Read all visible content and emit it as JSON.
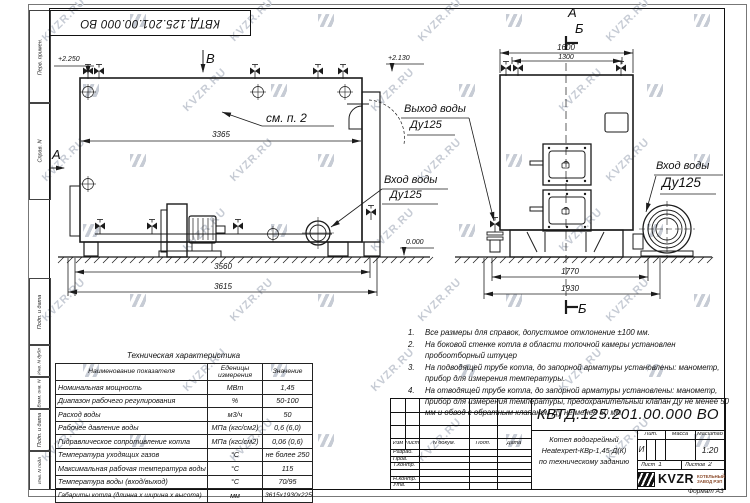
{
  "watermark": {
    "text": "KVZR.RU"
  },
  "sheet": {
    "flipped_doc_number": "КВТД.125.201.00.000 ВО",
    "format_note": "Формат А3"
  },
  "side_columns": {
    "items": [
      "Перв. примен.",
      "Справ. N",
      "Подп. и дата",
      "Инв. N дубл",
      "Взам. инв. N",
      "Подп. и дата",
      "Инв. N подл"
    ]
  },
  "views": {
    "side_view": {
      "view_label": "В",
      "section_label": "А",
      "callout": "см. п. 2",
      "elevation_top": "+2.250",
      "elevation_stack": "+2.130",
      "elevation_ground": "0.000",
      "dim_body": "3365",
      "dim_base": "3560",
      "dim_overall": "3615",
      "inlet_line1": "Вход воды",
      "inlet_line2": "Ду125"
    },
    "front_view": {
      "label_a": "А",
      "label_b": "Б",
      "label_b_bottom": "Б",
      "dim_top_outer": "1600",
      "dim_top_inner": "1300",
      "dim_base_inner": "1770",
      "dim_base_outer": "1930",
      "outlet_line1": "Выход воды",
      "outlet_line2": "Ду125",
      "inlet_line1": "Вход воды",
      "inlet_line2": "Ду125"
    }
  },
  "notes": {
    "items": [
      {
        "num": "1.",
        "text": "Все размеры для справок, допустимое отклонение ±100 мм."
      },
      {
        "num": "2.",
        "text": "На боковой стенке котла в области топочной камеры установлен пробоотборный штуцер"
      },
      {
        "num": "3.",
        "text": "На  подводящей трубе котла, до запорной арматуры установлены: манометр, прибор для измерения температуры."
      },
      {
        "num": "4.",
        "text": "На отводящей трубе котла, до запорной арматуры установлены: манометр, прибор для измерения температуры, предохранительный клапан Ду не менее 50 мм и обвод с обратным клапаном Ду не менее 50 мм."
      }
    ]
  },
  "spec_table": {
    "title": "Техническая характеристика",
    "headers": [
      "Наименование показателя",
      "Еденицы измерения",
      "Значение"
    ],
    "rows": [
      [
        "Номинальная мощность",
        "МВт",
        "1,45"
      ],
      [
        "Диапазон рабочего регулирования",
        "%",
        "50-100"
      ],
      [
        "Расход воды",
        "м3/ч",
        "50"
      ],
      [
        "Рабочее давление воды",
        "МПа (кгс/см2)",
        "0,6 (6,0)"
      ],
      [
        "Гидравлическое сопротивление котла",
        "МПа (кгс/см2)",
        "0,06 (0,6)"
      ],
      [
        "Температура уходящих газов",
        "°С",
        "не более 250"
      ],
      [
        "Максимальная рабочая температура воды",
        "°С",
        "115"
      ],
      [
        "Температура воды (вход/выход)",
        "°С",
        "70/95"
      ],
      [
        "Габариты котла (длинна х ширина х высота)",
        "мм",
        "3615х1930х2250"
      ]
    ]
  },
  "title_block": {
    "doc_number": "КВТД.125.201.00.000  ВО",
    "columns": [
      "Изм",
      "Лист",
      "N докум.",
      "Подп.",
      "Дата"
    ],
    "sign_rows": [
      "Разраб.",
      "Пров.",
      "Т.контр.",
      "",
      "Н.контр.",
      "Утв."
    ],
    "name_lines": [
      "Котел водогрейный",
      "Heatexpert-КВр-1,45-Д(К)",
      "по техническому заданию"
    ],
    "lit_label": "Лит.",
    "lit_value": "И",
    "mass_label": "Масса",
    "scale_label": "Масштаб",
    "scale_value": "1:20",
    "sheet_label": "Лист",
    "sheet_value": "1",
    "sheets_label": "Листов",
    "sheets_value": "2",
    "logo_text": "KVZR",
    "logo_sub1": "КОТЕЛЬНЫЙ",
    "logo_sub2": "ЗАВОД РЭП"
  }
}
